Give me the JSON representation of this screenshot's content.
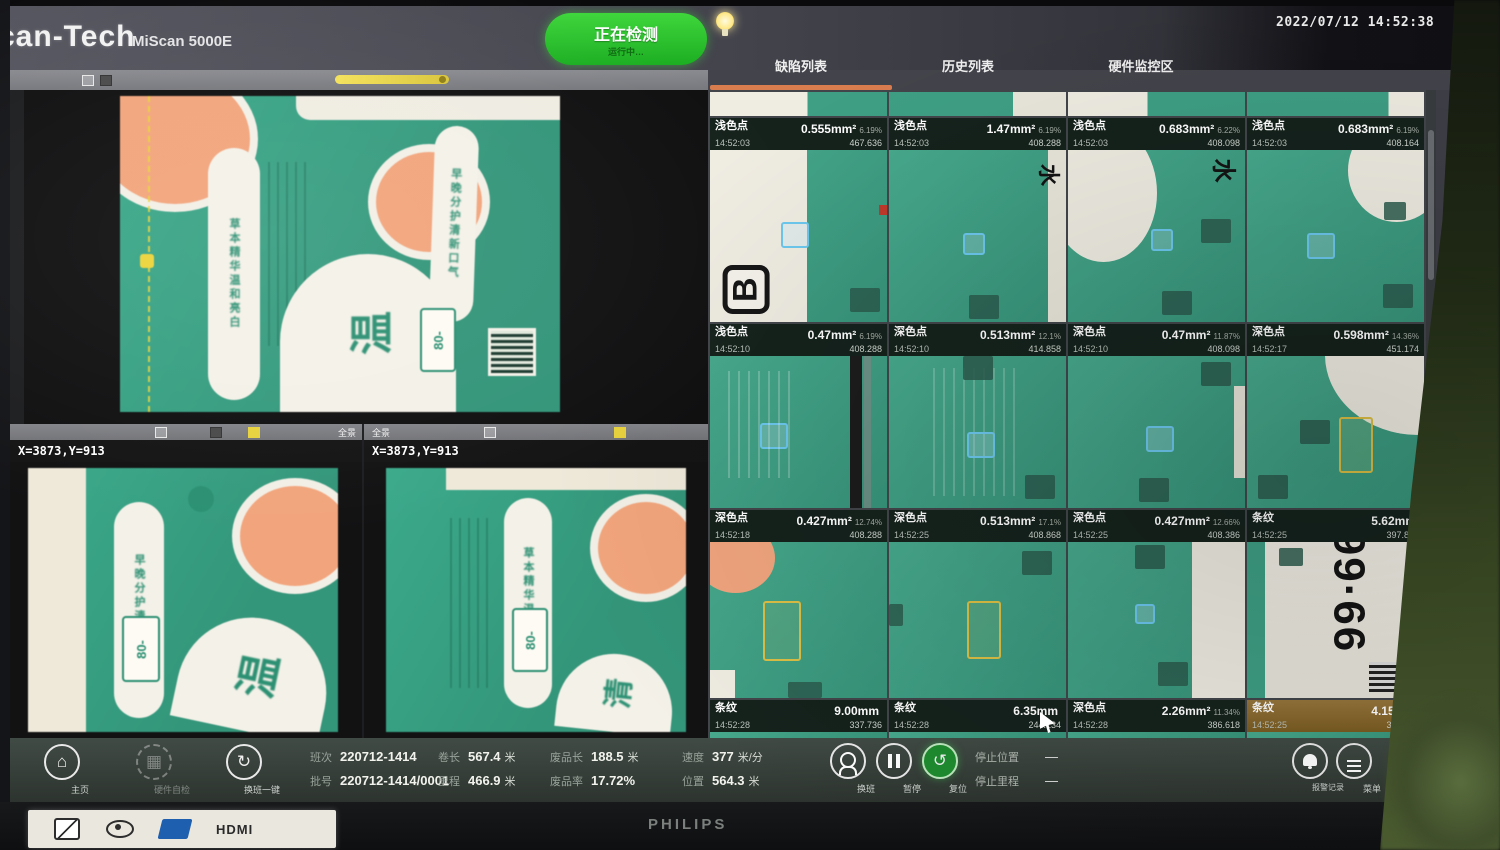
{
  "header": {
    "logo": "can-Tech",
    "model": "MiScan 5000E",
    "run_button": {
      "label": "正在检测",
      "sub": "运行中…"
    },
    "timestamp": "2022/07/12 14:52:38"
  },
  "tabs": [
    {
      "label": "缺陷列表",
      "active": true
    },
    {
      "label": "历史列表",
      "active": false
    },
    {
      "label": "硬件监控区",
      "active": false
    }
  ],
  "cameras": {
    "sub1": {
      "coords": "X=3873,Y=913"
    },
    "sub2": {
      "coords": "X=3873,Y=913"
    },
    "strip_button_label": "全景"
  },
  "artwork": {
    "big_char": "温",
    "big_char2": "清",
    "pill_text1": "草本精华温和亮白",
    "pill_text2": "早晚分护清新口气",
    "small_pill": "80-",
    "rotated_char": "水",
    "glyph_b": "B",
    "digits": "99·66"
  },
  "defects": {
    "tiles": [
      {
        "variant": "v1",
        "type": "浅色点",
        "size": "0.555mm²",
        "pct": "6.19%",
        "time": "14:52:03",
        "num": "467.636",
        "selected": false
      },
      {
        "variant": "v2",
        "type": "浅色点",
        "size": "1.47mm²",
        "pct": "6.19%",
        "time": "14:52:03",
        "num": "408.288",
        "selected": false
      },
      {
        "variant": "v3",
        "type": "浅色点",
        "size": "0.683mm²",
        "pct": "6.22%",
        "time": "14:52:03",
        "num": "408.098",
        "selected": false
      },
      {
        "variant": "v4",
        "type": "浅色点",
        "size": "0.683mm²",
        "pct": "6.19%",
        "time": "14:52:03",
        "num": "408.164",
        "selected": false
      },
      {
        "variant": "v5",
        "type": "浅色点",
        "size": "0.47mm²",
        "pct": "6.19%",
        "time": "14:52:10",
        "num": "408.288",
        "selected": false
      },
      {
        "variant": "v6",
        "type": "深色点",
        "size": "0.513mm²",
        "pct": "12.1%",
        "time": "14:52:10",
        "num": "414.858",
        "selected": false
      },
      {
        "variant": "v7",
        "type": "深色点",
        "size": "0.47mm²",
        "pct": "11.87%",
        "time": "14:52:10",
        "num": "408.098",
        "selected": false
      },
      {
        "variant": "v8",
        "type": "深色点",
        "size": "0.598mm²",
        "pct": "14.36%",
        "time": "14:52:17",
        "num": "451.174",
        "selected": false
      },
      {
        "variant": "v9",
        "type": "深色点",
        "size": "0.427mm²",
        "pct": "12.74%",
        "time": "14:52:18",
        "num": "408.288",
        "selected": false
      },
      {
        "variant": "v10",
        "type": "深色点",
        "size": "0.513mm²",
        "pct": "17.1%",
        "time": "14:52:25",
        "num": "408.868",
        "selected": false
      },
      {
        "variant": "v11",
        "type": "深色点",
        "size": "0.427mm²",
        "pct": "12.66%",
        "time": "14:52:25",
        "num": "408.386",
        "selected": false
      },
      {
        "variant": "v12",
        "type": "条纹",
        "size": "5.62mm",
        "pct": "",
        "time": "14:52:25",
        "num": "397.859",
        "selected": false
      },
      {
        "variant": "v13",
        "type": "条纹",
        "size": "9.00mm",
        "pct": "",
        "time": "14:52:28",
        "num": "337.736",
        "selected": false
      },
      {
        "variant": "v14",
        "type": "条纹",
        "size": "6.35mm",
        "pct": "",
        "time": "14:52:28",
        "num": "244.134",
        "selected": false
      },
      {
        "variant": "v15",
        "type": "深色点",
        "size": "2.26mm²",
        "pct": "11.34%",
        "time": "14:52:28",
        "num": "386.618",
        "selected": false
      },
      {
        "variant": "v16",
        "type": "条纹",
        "size": "4.15mm",
        "pct": "",
        "time": "14:52:25",
        "num": "344.154",
        "selected": true
      }
    ]
  },
  "toolbar": {
    "nav": [
      {
        "label": "主页"
      },
      {
        "label": "硬件自检"
      },
      {
        "label": "换班一键"
      }
    ],
    "stats": [
      {
        "label": "班次",
        "value": "220712-1414",
        "unit": ""
      },
      {
        "label": "批号",
        "value": "220712-1414/0001",
        "unit": ""
      },
      {
        "label": "卷长",
        "value": "567.4",
        "unit": "米"
      },
      {
        "label": "里程",
        "value": "466.9",
        "unit": "米"
      },
      {
        "label": "废品长",
        "value": "188.5",
        "unit": "米"
      },
      {
        "label": "废品率",
        "value": "17.72%",
        "unit": ""
      },
      {
        "label": "速度",
        "value": "377",
        "unit": "米/分"
      },
      {
        "label": "位置",
        "value": "564.3",
        "unit": "米"
      }
    ],
    "controls": [
      {
        "label": "换班"
      },
      {
        "label": "暂停"
      },
      {
        "label": "复位"
      }
    ],
    "stops": [
      {
        "label": "停止位置",
        "value": "—"
      },
      {
        "label": "停止里程",
        "value": "—"
      }
    ],
    "right": [
      {
        "label": "报警记录"
      },
      {
        "label": "菜单"
      }
    ]
  },
  "brand": {
    "monitor": "PHILIPS",
    "hdmi": "HDMI"
  }
}
